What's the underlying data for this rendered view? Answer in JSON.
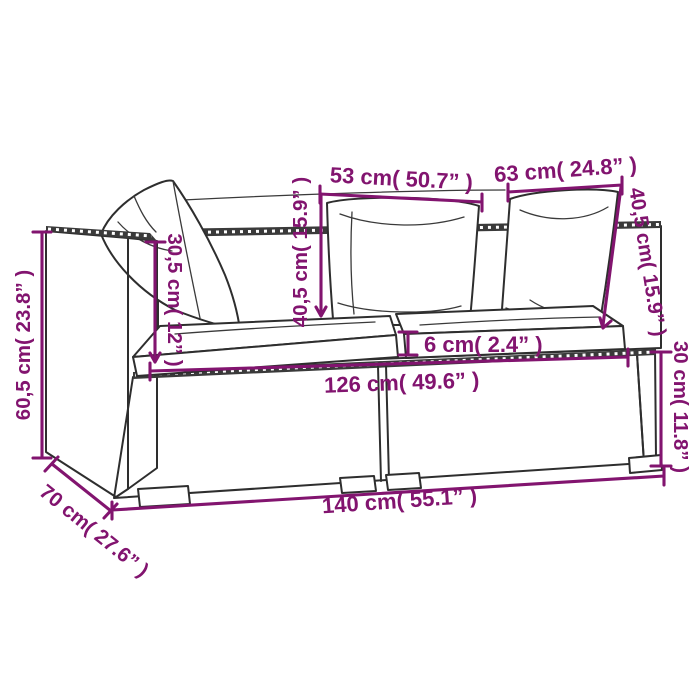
{
  "figure": {
    "kind": "furniture-dimension-diagram",
    "subject": "poly rattan 2-seat garden sofa with cushions, technical line drawing",
    "accent_color": "#82146F",
    "sketch_color": "#2E2E2E",
    "background": "#FFFFFF"
  },
  "dims": {
    "total_width": {
      "label": "140 cm( 55.1” )"
    },
    "total_depth": {
      "label": "70 cm( 27.6” )"
    },
    "total_height": {
      "label": "60,5 cm( 23.8” )"
    },
    "base_height": {
      "label": "30 cm( 11.8” )"
    },
    "seat_width": {
      "label": "126 cm( 49.6” )"
    },
    "seat_cushion_thickness": {
      "label": "6 cm( 2.4” )"
    },
    "armrest_height_above_seat": {
      "label": "30,5 cm( 12” )"
    },
    "back_cushion_left_width": {
      "label": "53 cm( 50.7” )"
    },
    "back_cushion_left_height": {
      "label": "40,5 cm( 15.9” )"
    },
    "back_cushion_right_width": {
      "label": "63 cm( 24.8” )"
    },
    "back_cushion_right_height": {
      "label": "40,5 cm( 15.9” )"
    }
  }
}
